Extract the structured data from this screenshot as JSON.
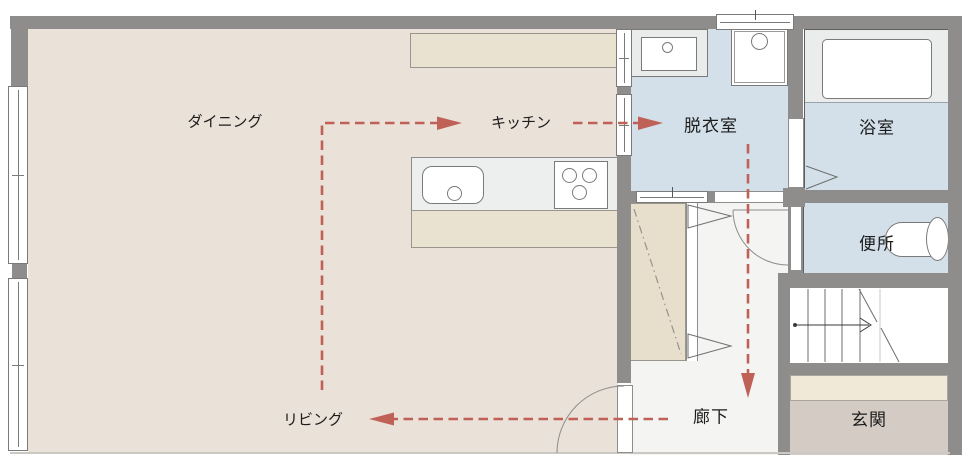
{
  "rooms": {
    "dining": {
      "label": "ダイニング"
    },
    "kitchen": {
      "label": "キッチン"
    },
    "dressing_room": {
      "label": "脱衣室"
    },
    "bathroom": {
      "label": "浴室"
    },
    "toilet": {
      "label": "便所"
    },
    "hallway": {
      "label": "廊下"
    },
    "entrance": {
      "label": "玄関"
    },
    "living": {
      "label": "リビング"
    }
  },
  "colors": {
    "wall": "#8e8d8b",
    "dining_floor": "#eae1d8",
    "wet_area_floor": "#d3e0e9",
    "hallway_floor": "#f4f4f2",
    "counter_cabinet": "#eae2d0",
    "counter_top": "#edefee",
    "bath_platform": "#ebedec",
    "closet": "#e7dfcb",
    "entrance_step": "#f0e9d7",
    "entrance_floor": "#d4ccc4",
    "flow_arrow": "#bf6156",
    "label_text": "#1c1c1c"
  }
}
